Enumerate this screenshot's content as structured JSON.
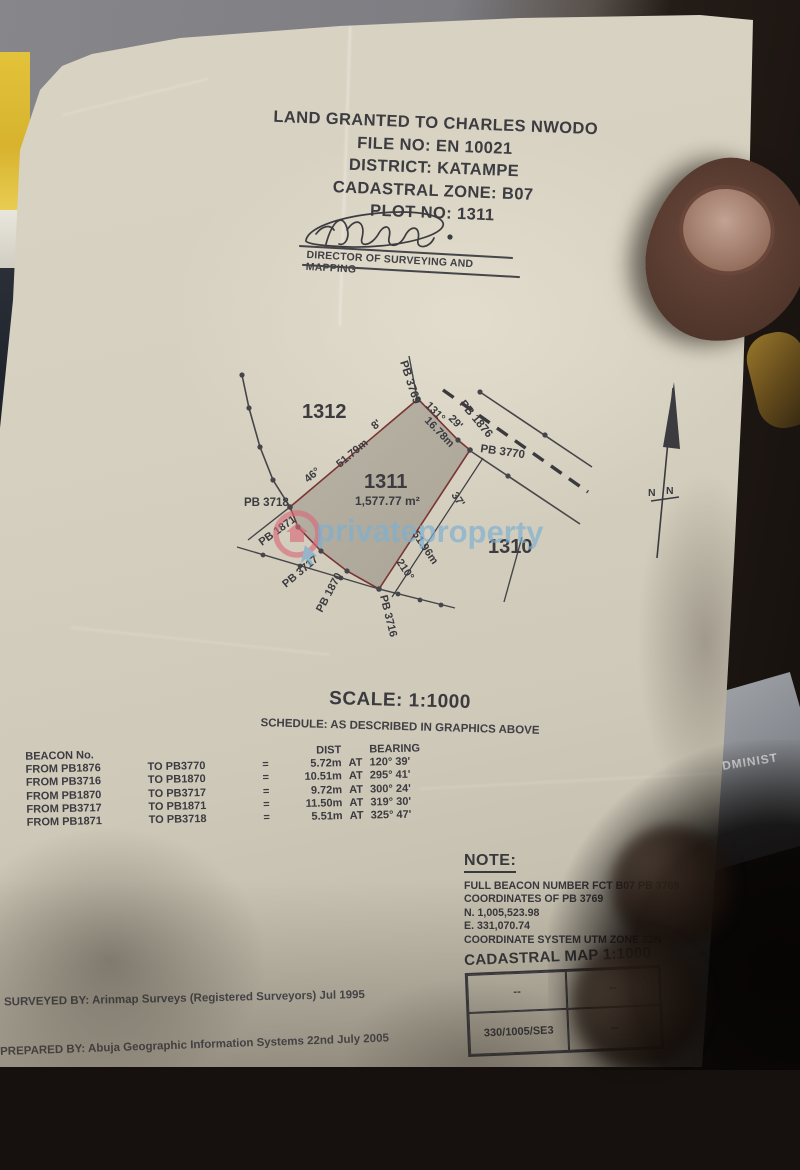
{
  "photo": {
    "background_fragment_text": "ADMINIST",
    "watermark": {
      "text": "privateproperty",
      "logo_icon": "house-in-circle-with-cursor",
      "accent_blue": "#7cafd1",
      "accent_pink": "#d8697a"
    }
  },
  "document": {
    "title_block": {
      "lines": [
        "LAND GRANTED TO CHARLES NWODO",
        "FILE NO: EN 10021",
        "DISTRICT: KATAMPE",
        "CADASTRAL ZONE: B07",
        "PLOT NO: 1311"
      ]
    },
    "signature_caption": "DIRECTOR OF SURVEYING AND MAPPING",
    "plan": {
      "plot_1312": "1312",
      "plot_1311": "1311",
      "area_1311": "1,577.77 m²",
      "plot_1310": "1310",
      "pb_3718": "PB 3718",
      "pb_3769": "PB 3769",
      "pb_1876": "PB 1876",
      "pb_3770": "PB 3770",
      "pb_1871": "PB 1871",
      "pb_3717": "PB 3717",
      "pb_1870": "PB 1870",
      "pb_3716": "PB 3716",
      "nw_bearing_deg": "46°",
      "nw_dist": "51.79m",
      "nw_bearing_min": "8'",
      "ne_bearing_deg": "131°",
      "ne_dist": "16.78m",
      "ne_bearing_min": "29'",
      "se_bearing_min": "37'",
      "se_dist": "51.96m",
      "se_bearing_deg": "210°",
      "north_n1": "N",
      "north_n2": "N"
    },
    "scale_text": "SCALE: 1:1000",
    "schedule_text": "SCHEDULE: AS DESCRIBED IN GRAPHICS ABOVE",
    "beacon_table": {
      "header_beacon": "BEACON No.",
      "header_dist": "DIST",
      "header_bearing": "BEARING",
      "rows": [
        {
          "from": "FROM PB1876",
          "to": "TO PB3770",
          "eq": "=",
          "dist": "5.72m",
          "at": "AT",
          "bearing": "120° 39'"
        },
        {
          "from": "FROM PB3716",
          "to": "TO PB1870",
          "eq": "=",
          "dist": "10.51m",
          "at": "AT",
          "bearing": "295° 41'"
        },
        {
          "from": "FROM PB1870",
          "to": "TO PB3717",
          "eq": "=",
          "dist": "9.72m",
          "at": "AT",
          "bearing": "300° 24'"
        },
        {
          "from": "FROM PB3717",
          "to": "TO PB1871",
          "eq": "=",
          "dist": "11.50m",
          "at": "AT",
          "bearing": "319° 30'"
        },
        {
          "from": "FROM PB1871",
          "to": "TO PB3718",
          "eq": "=",
          "dist": "5.51m",
          "at": "AT",
          "bearing": "325° 47'"
        }
      ]
    },
    "note": {
      "heading": "NOTE:",
      "lines": [
        "FULL BEACON NUMBER FCT B07 PB 3769",
        "COORDINATES OF PB 3769",
        "N. 1,005,523.98",
        "E. 331,070.74",
        "COORDINATE SYSTEM UTM ZONE 32N"
      ]
    },
    "cadastral_map": {
      "title": "CADASTRAL MAP 1:1000",
      "c11": "--",
      "c12": "--",
      "c21": "330/1005/SE3",
      "c22": "--"
    },
    "surveyed_by": "SURVEYED BY: Arinmap Surveys (Registered Surveyors)  Jul 1995",
    "prepared_by": "PREPARED BY: Abuja Geographic Information Systems  22nd July 2005"
  }
}
